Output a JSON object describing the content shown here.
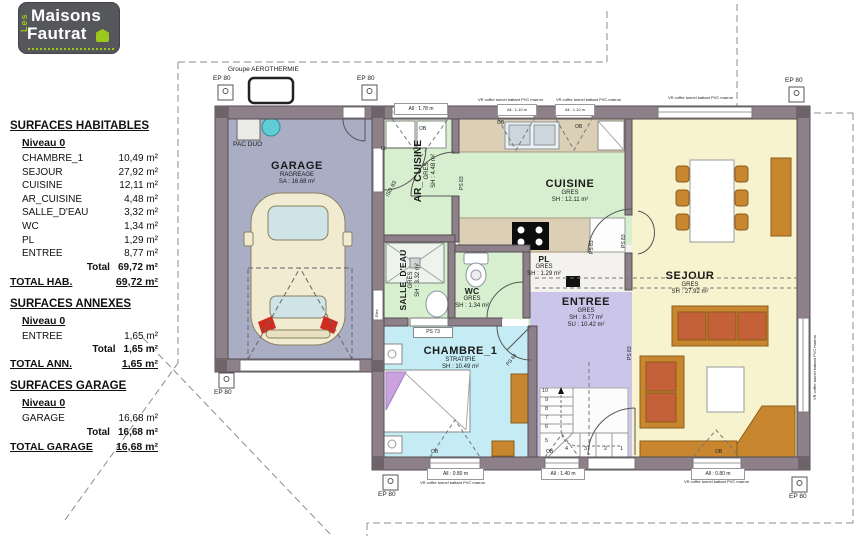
{
  "logo": {
    "vertical": "Les",
    "line1": "Maisons",
    "line2": "Fautrat"
  },
  "surfaces": {
    "habitables": {
      "title": "SURFACES HABITABLES",
      "level": "Niveau 0",
      "rows": [
        {
          "name": "CHAMBRE_1",
          "area": "10,49 m²"
        },
        {
          "name": "SEJOUR",
          "area": "27,92 m²"
        },
        {
          "name": "CUISINE",
          "area": "12,11 m²"
        },
        {
          "name": "AR_CUISINE",
          "area": "4,48 m²"
        },
        {
          "name": "SALLE_D'EAU",
          "area": "3,32 m²"
        },
        {
          "name": "WC",
          "area": "1,34 m²"
        },
        {
          "name": "PL",
          "area": "1,29 m²"
        },
        {
          "name": "ENTREE",
          "area": "8,77 m²"
        }
      ],
      "total_label": "Total",
      "total_value": "69,72 m²",
      "grand_label": "TOTAL HAB.",
      "grand_value": "69,72 m²"
    },
    "annexes": {
      "title": "SURFACES ANNEXES",
      "level": "Niveau 0",
      "rows": [
        {
          "name": "ENTREE",
          "area": "1,65 m²"
        }
      ],
      "total_label": "Total",
      "total_value": "1,65 m²",
      "grand_label": "TOTAL ANN.",
      "grand_value": "1,65 m²"
    },
    "garage": {
      "title": "SURFACES GARAGE",
      "level": "Niveau 0",
      "rows": [
        {
          "name": "GARAGE",
          "area": "16,68 m²"
        }
      ],
      "total_label": "Total",
      "total_value": "16,68 m²",
      "grand_label": "TOTAL GARAGE",
      "grand_value": "16,68 m²"
    }
  },
  "plan": {
    "garage": {
      "name": "GARAGE",
      "finish": "RAGREAGE",
      "area": "SA : 16.68 m²"
    },
    "ar_cuisine": {
      "name": "AR_CUISINE",
      "finish": "GRES",
      "area": "SH : 4.48 m²"
    },
    "cuisine": {
      "name": "CUISINE",
      "finish": "GRES",
      "area": "SH : 12.11 m²"
    },
    "salle_deau": {
      "name": "SALLE_D'EAU",
      "finish": "GRES",
      "area": "SH : 3.32 m²"
    },
    "wc": {
      "name": "WC",
      "finish": "GRES",
      "area": "SH : 1.34 m²"
    },
    "pl": {
      "name": "PL",
      "finish": "GRES",
      "area": "SH : 1.29 m²"
    },
    "entree": {
      "name": "ENTREE",
      "finish": "GRES",
      "area": "SH : 8.77 m²",
      "area2": "SU : 10.42 m²"
    },
    "chambre": {
      "name": "CHAMBRE_1",
      "finish": "STRATIFIE",
      "area": "SH : 10.49 m²"
    },
    "sejour": {
      "name": "SEJOUR",
      "finish": "GRES",
      "area": "SH : 27.92 m²"
    },
    "markers": {
      "ep80": "EP 80",
      "pac_duo": "PAC DUO",
      "aerothermie": "Groupe AEROTHERMIE",
      "ll": "LL",
      "elec": "Elec"
    },
    "doors": {
      "iso83": "ISO 83",
      "ps83": "PS 83",
      "ps73": "PS 73",
      "ps63": "PS 63"
    },
    "window_tag": "OB",
    "windows": {
      "w1": "All : 1.78 m",
      "w2": "All : 1.10 m",
      "w3": "All : 1.10 m",
      "w_chambre": "All : 0.80 m",
      "w_stair": "All : 1.40 m",
      "w_sejour": "All : 0.80 m"
    },
    "vr_note": "VR coffre tunnel battant PVC marron",
    "stairs": [
      "1",
      "2",
      "3",
      "4",
      "5",
      "6",
      "7",
      "8",
      "9",
      "10"
    ]
  }
}
